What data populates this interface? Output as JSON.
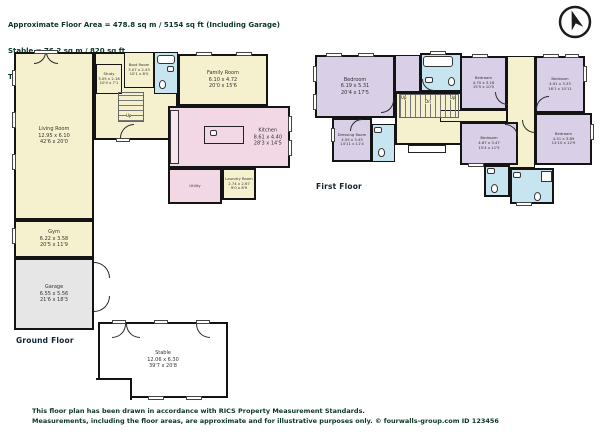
{
  "header": {
    "line1": "Approximate Floor Area = 478.8 sq m / 5154 sq ft (Including Garage)",
    "line2": "Stable = 76.2 sq m / 820 sq ft",
    "line3": "Total = 555.0 sq m / 5974 sq ft"
  },
  "footer": {
    "line1": "This floor plan has been drawn in accordance with RICS Property Measurement Standards.",
    "line2": "Measurements, including the floor areas, are approximate and for illustrative purposes only. © fourwalls-group.com ID 123456"
  },
  "icons": {
    "compass": "north-compass-icon"
  },
  "colors": {
    "room_yellow": "#f5f0cd",
    "room_pink": "#f2d8e5",
    "room_purple": "#d9cfe6",
    "room_blue": "#c7e5f1",
    "room_gray": "#e6e6e6",
    "wall": "#141414",
    "text_green": "#0a3622"
  },
  "floors": {
    "ground": {
      "label": "Ground Floor",
      "stairs": {
        "up": "Up"
      },
      "rooms": [
        {
          "name": "Living Room",
          "metric": "12.95 x 6.10",
          "imperial": "42'6 x 20'0"
        },
        {
          "name": "Study",
          "metric": "3.05 x 2.16",
          "imperial": "10'0 x 7'1"
        },
        {
          "name": "Boot Room",
          "metric": "3.07 x 2.43",
          "imperial": "10'1 x 8'0"
        },
        {
          "name": "Family Room",
          "metric": "6.10 x 4.72",
          "imperial": "20'0 x 15'6"
        },
        {
          "name": "Kitchen",
          "metric": "8.61 x 4.40",
          "imperial": "28'3 x 14'5"
        },
        {
          "name": "Utility",
          "metric": "",
          "imperial": ""
        },
        {
          "name": "Laundry Room",
          "metric": "2.74 x 2.67",
          "imperial": "9'0 x 8'9"
        },
        {
          "name": "Gym",
          "metric": "6.22 x 3.58",
          "imperial": "20'5 x 11'9"
        },
        {
          "name": "Garage",
          "metric": "6.55 x 5.56",
          "imperial": "21'6 x 18'3"
        },
        {
          "name": "Stable",
          "metric": "12.06 x 6.30",
          "imperial": "39'7 x 20'8"
        }
      ]
    },
    "first": {
      "label": "First Floor",
      "stairs": {
        "up1": "Up",
        "dn": "Dn",
        "up2": "Up"
      },
      "rooms": [
        {
          "name": "Bedroom",
          "metric": "6.19 x 5.31",
          "imperial": "20'4 x 17'5"
        },
        {
          "name": "Dressing Room",
          "metric": "4.55 x 3.45",
          "imperial": "14'11 x 11'4"
        },
        {
          "name": "Bedroom",
          "metric": "4.70 x 3.18",
          "imperial": "15'5 x 10'5"
        },
        {
          "name": "Bedroom",
          "metric": "4.91 x 3.33",
          "imperial": "16'1 x 10'11"
        },
        {
          "name": "Bedroom",
          "metric": "4.51 x 3.89",
          "imperial": "14'10 x 12'9"
        },
        {
          "name": "Bedroom",
          "metric": "4.67 x 3.47",
          "imperial": "15'4 x 11'5"
        }
      ]
    }
  }
}
